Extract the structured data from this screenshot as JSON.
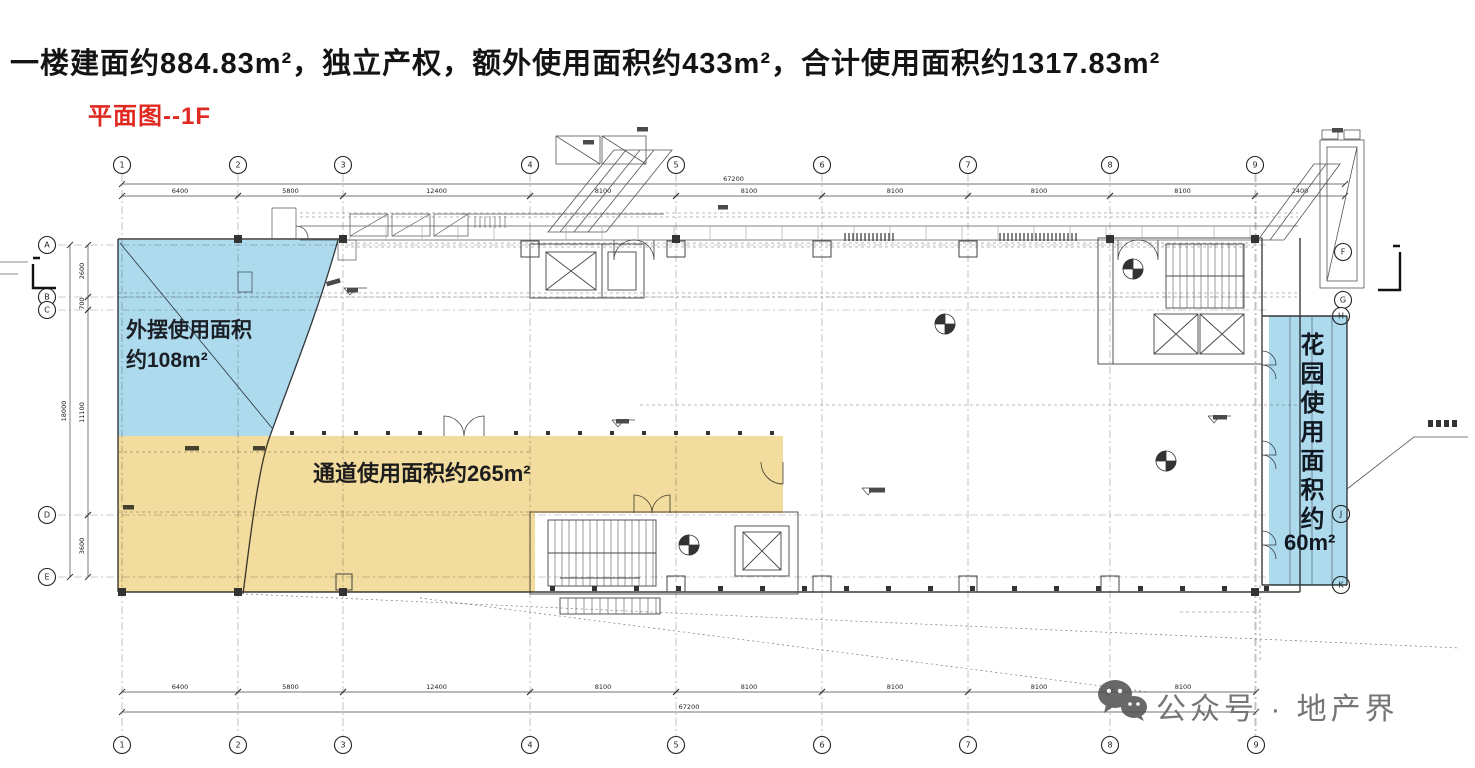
{
  "page": {
    "width": 1475,
    "height": 768,
    "background": "#ffffff"
  },
  "header": {
    "title": "一楼建面约884.83m²，独立产权，额外使用面积约433m²，合计使用面积约1317.83m²",
    "plan_label": "平面图--1F",
    "plan_label_color": "#e02a21"
  },
  "regions": {
    "outdoor_seating": {
      "line1": "外摆使用面积",
      "line2": "约108m²",
      "color": "#7cc4e4"
    },
    "passage": {
      "label": "通道使用面积约265m²",
      "color": "#eccb70"
    },
    "garden": {
      "label_vertical": "花园使用面积约",
      "value": "60m²",
      "color": "#7cc4e4"
    }
  },
  "watermark": {
    "text": "公众号 · 地产界",
    "color": "#757575",
    "icon": "wechat-icon"
  },
  "grid": {
    "top_bubbles": [
      {
        "x": 122,
        "label": "1"
      },
      {
        "x": 238,
        "label": "2"
      },
      {
        "x": 343,
        "label": "3"
      },
      {
        "x": 530,
        "label": "4"
      },
      {
        "x": 676,
        "label": "5"
      },
      {
        "x": 822,
        "label": "6"
      },
      {
        "x": 968,
        "label": "7"
      },
      {
        "x": 1110,
        "label": "8"
      },
      {
        "x": 1255,
        "label": "9"
      }
    ],
    "bottom_bubbles": [
      {
        "x": 122,
        "label": "1"
      },
      {
        "x": 238,
        "label": "2"
      },
      {
        "x": 343,
        "label": "3"
      },
      {
        "x": 530,
        "label": "4"
      },
      {
        "x": 676,
        "label": "5"
      },
      {
        "x": 822,
        "label": "6"
      },
      {
        "x": 968,
        "label": "7"
      },
      {
        "x": 1110,
        "label": "8"
      },
      {
        "x": 1256,
        "label": "9"
      }
    ],
    "left_bubbles": [
      {
        "y": 245,
        "label": "A"
      },
      {
        "y": 297,
        "label": "B"
      },
      {
        "y": 310,
        "label": "C"
      },
      {
        "y": 515,
        "label": "D"
      },
      {
        "y": 577,
        "label": "E"
      }
    ],
    "right_bubbles": [
      {
        "x": 1343,
        "y": 252,
        "label": "F"
      },
      {
        "x": 1343,
        "y": 300,
        "label": "G"
      },
      {
        "x": 1341,
        "y": 316,
        "label": "H"
      },
      {
        "x": 1341,
        "y": 514,
        "label": "J"
      },
      {
        "x": 1341,
        "y": 585,
        "label": "K"
      }
    ]
  },
  "dimensions": {
    "top_segments": [
      {
        "x1": 122,
        "x2": 238,
        "label": "6400"
      },
      {
        "x1": 238,
        "x2": 343,
        "label": "5800"
      },
      {
        "x1": 343,
        "x2": 530,
        "label": "12400"
      },
      {
        "x1": 530,
        "x2": 676,
        "label": "8100"
      },
      {
        "x1": 676,
        "x2": 822,
        "label": "8100"
      },
      {
        "x1": 822,
        "x2": 968,
        "label": "8100"
      },
      {
        "x1": 968,
        "x2": 1110,
        "label": "8100"
      },
      {
        "x1": 1110,
        "x2": 1255,
        "label": "8100"
      },
      {
        "x1": 1255,
        "x2": 1345,
        "label": "2400"
      }
    ],
    "top_total": {
      "x1": 122,
      "x2": 1345,
      "label": "67200"
    },
    "bottom_segments": [
      {
        "x1": 122,
        "x2": 238,
        "label": "6400"
      },
      {
        "x1": 238,
        "x2": 343,
        "label": "5800"
      },
      {
        "x1": 343,
        "x2": 530,
        "label": "12400"
      },
      {
        "x1": 530,
        "x2": 676,
        "label": "8100"
      },
      {
        "x1": 676,
        "x2": 822,
        "label": "8100"
      },
      {
        "x1": 822,
        "x2": 968,
        "label": "8100"
      },
      {
        "x1": 968,
        "x2": 1110,
        "label": "8100"
      },
      {
        "x1": 1110,
        "x2": 1256,
        "label": "8100"
      }
    ],
    "bottom_total": {
      "x1": 122,
      "x2": 1256,
      "label": "67200"
    },
    "left_segments": [
      {
        "y1": 245,
        "y2": 297,
        "label": "2600"
      },
      {
        "y1": 297,
        "y2": 310,
        "label": "700"
      },
      {
        "y1": 310,
        "y2": 515,
        "label": "11100"
      },
      {
        "y1": 515,
        "y2": 577,
        "label": "3600"
      }
    ],
    "left_total": {
      "y1": 245,
      "y2": 577,
      "label": "18000"
    }
  }
}
